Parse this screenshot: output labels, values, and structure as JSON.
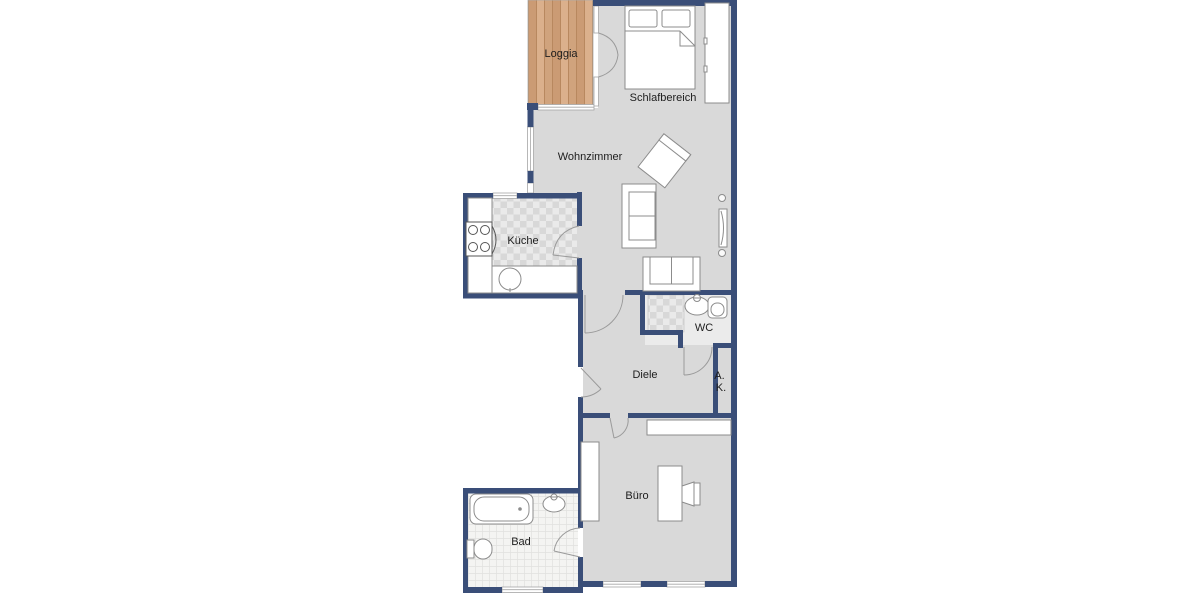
{
  "rooms": {
    "loggia": {
      "label": "Loggia"
    },
    "schlafbereich": {
      "label": "Schlafbereich"
    },
    "wohnzimmer": {
      "label": "Wohnzimmer"
    },
    "kueche": {
      "label": "Küche"
    },
    "wc": {
      "label": "WC"
    },
    "diele": {
      "label": "Diele"
    },
    "abstellkammer": {
      "line1": "A.",
      "line2": "K."
    },
    "buero": {
      "label": "Büro"
    },
    "bad": {
      "label": "Bad"
    }
  },
  "colors": {
    "wall": "#3a4e78",
    "floor": "#d9d9d9",
    "wc_floor": "#ebebeb",
    "wood": "#d3a684",
    "furniture_outline": "#8c8c8c",
    "door_line": "#9a9a9a",
    "window": "#ffffff",
    "window_line": "#a6a6a6",
    "label": "#1d1d1d"
  }
}
